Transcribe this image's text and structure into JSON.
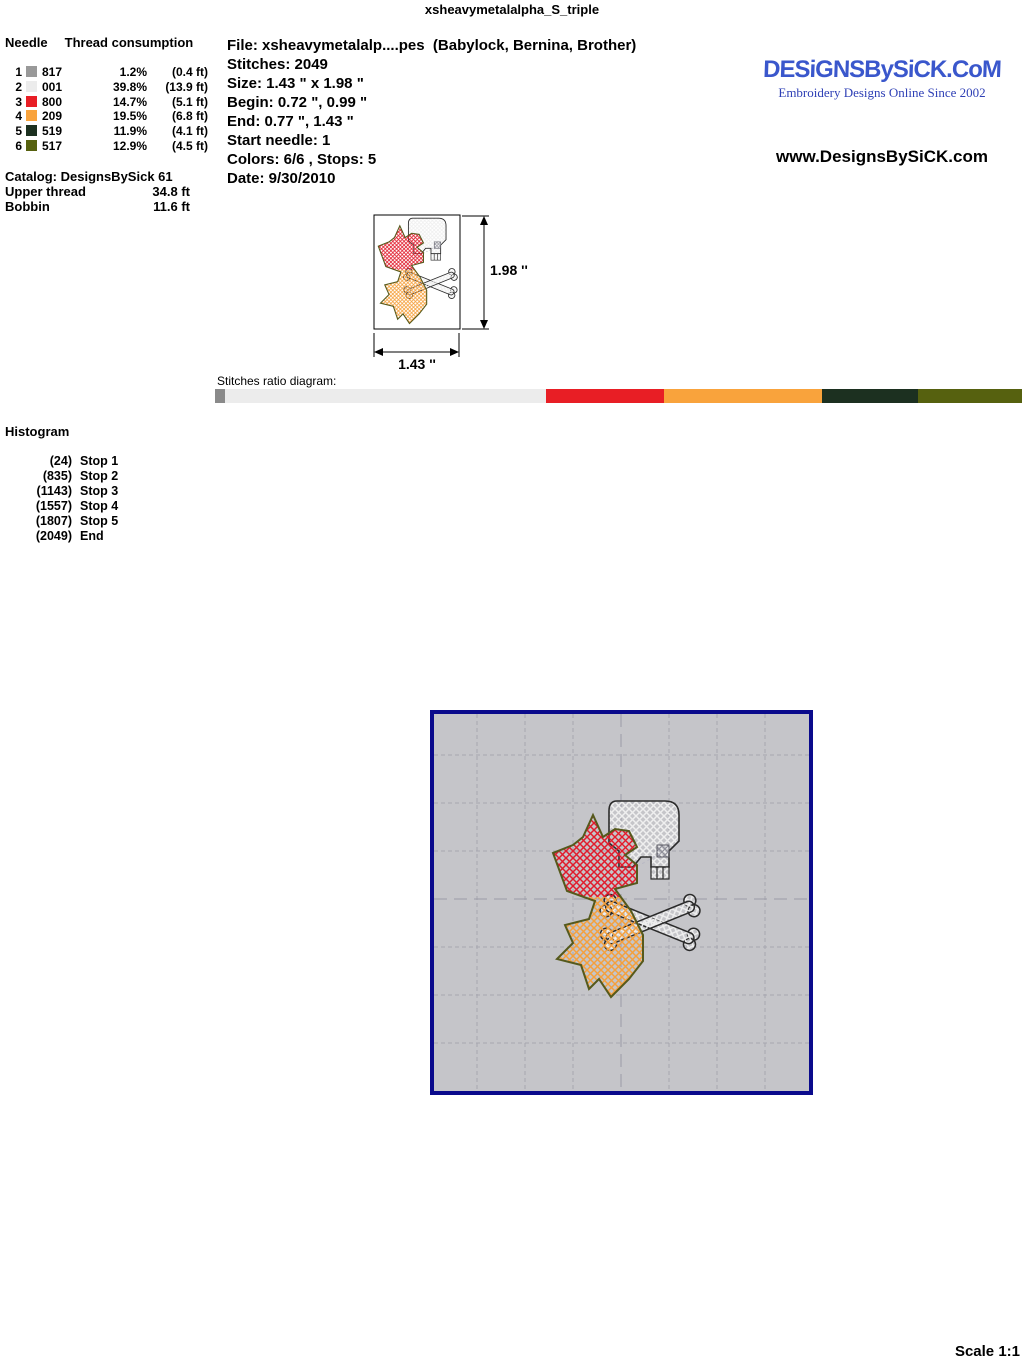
{
  "page_title": "xsheavymetalalpha_S_triple",
  "needle_table": {
    "header_needle": "Needle",
    "header_thread": "Thread consumption",
    "rows": [
      {
        "num": "1",
        "color": "#999999",
        "thread": "817",
        "pct": "1.2%",
        "len": "(0.4 ft)"
      },
      {
        "num": "2",
        "color": "#ececec",
        "thread": "001",
        "pct": "39.8%",
        "len": "(13.9 ft)"
      },
      {
        "num": "3",
        "color": "#e81e25",
        "thread": "800",
        "pct": "14.7%",
        "len": "(5.1 ft)"
      },
      {
        "num": "4",
        "color": "#f9a33c",
        "thread": "209",
        "pct": "19.5%",
        "len": "(6.8 ft)"
      },
      {
        "num": "5",
        "color": "#1c3020",
        "thread": "519",
        "pct": "11.9%",
        "len": "(4.1 ft)"
      },
      {
        "num": "6",
        "color": "#56610f",
        "thread": "517",
        "pct": "12.9%",
        "len": "(4.5 ft)"
      }
    ]
  },
  "catalog": {
    "catalog_line": "Catalog: DesignsBySick 61",
    "upper_thread_label": "Upper thread",
    "upper_thread_value": "34.8 ft",
    "bobbin_label": "Bobbin",
    "bobbin_value": "11.6 ft"
  },
  "file_info": {
    "file": "File: xsheavymetalalp....pes  (Babylock, Bernina, Brother)",
    "stitches": "Stitches: 2049",
    "size": "Size: 1.43 \" x 1.98 \"",
    "begin": "Begin: 0.72 \", 0.99 \"",
    "end": "End: 0.77 \", 1.43 \"",
    "start_needle": "Start needle: 1",
    "colors": "Colors: 6/6 , Stops: 5",
    "date": "Date: 9/30/2010"
  },
  "brand": {
    "logo": "DESiGNSBySiCK.CoM",
    "tagline": "Embroidery Designs Online Since 2002",
    "url": "www.DesignsBySiCK.com"
  },
  "dimensions": {
    "height_label": "1.98 ''",
    "width_label": "1.43 ''"
  },
  "ratio_diagram": {
    "label": "Stitches ratio diagram:",
    "segments": [
      {
        "color": "#8a8a8a",
        "pct": 1.2
      },
      {
        "color": "#ececec",
        "pct": 39.8
      },
      {
        "color": "#e81e25",
        "pct": 14.7
      },
      {
        "color": "#f9a33c",
        "pct": 19.5
      },
      {
        "color": "#1c3020",
        "pct": 11.9
      },
      {
        "color": "#56610f",
        "pct": 12.9
      }
    ]
  },
  "histogram": {
    "title": "Histogram",
    "entries": [
      {
        "count": "(24)",
        "label": "Stop 1"
      },
      {
        "count": "(835)",
        "label": "Stop 2"
      },
      {
        "count": "(1143)",
        "label": "Stop 3"
      },
      {
        "count": "(1557)",
        "label": "Stop 4"
      },
      {
        "count": "(1807)",
        "label": "Stop 5"
      },
      {
        "count": "(2049)",
        "label": "End"
      }
    ]
  },
  "design_colors": {
    "letter_top_hatch": "#e11c2c",
    "letter_bottom_hatch": "#f5a03c",
    "letter_outline": "#55591c",
    "skull_hatch": "#e8e8e8",
    "skull_outline": "#2b2b2b",
    "preview_border": "#0a0a8c",
    "preview_background": "#c5c5c9"
  },
  "scale_label": "Scale 1:1"
}
